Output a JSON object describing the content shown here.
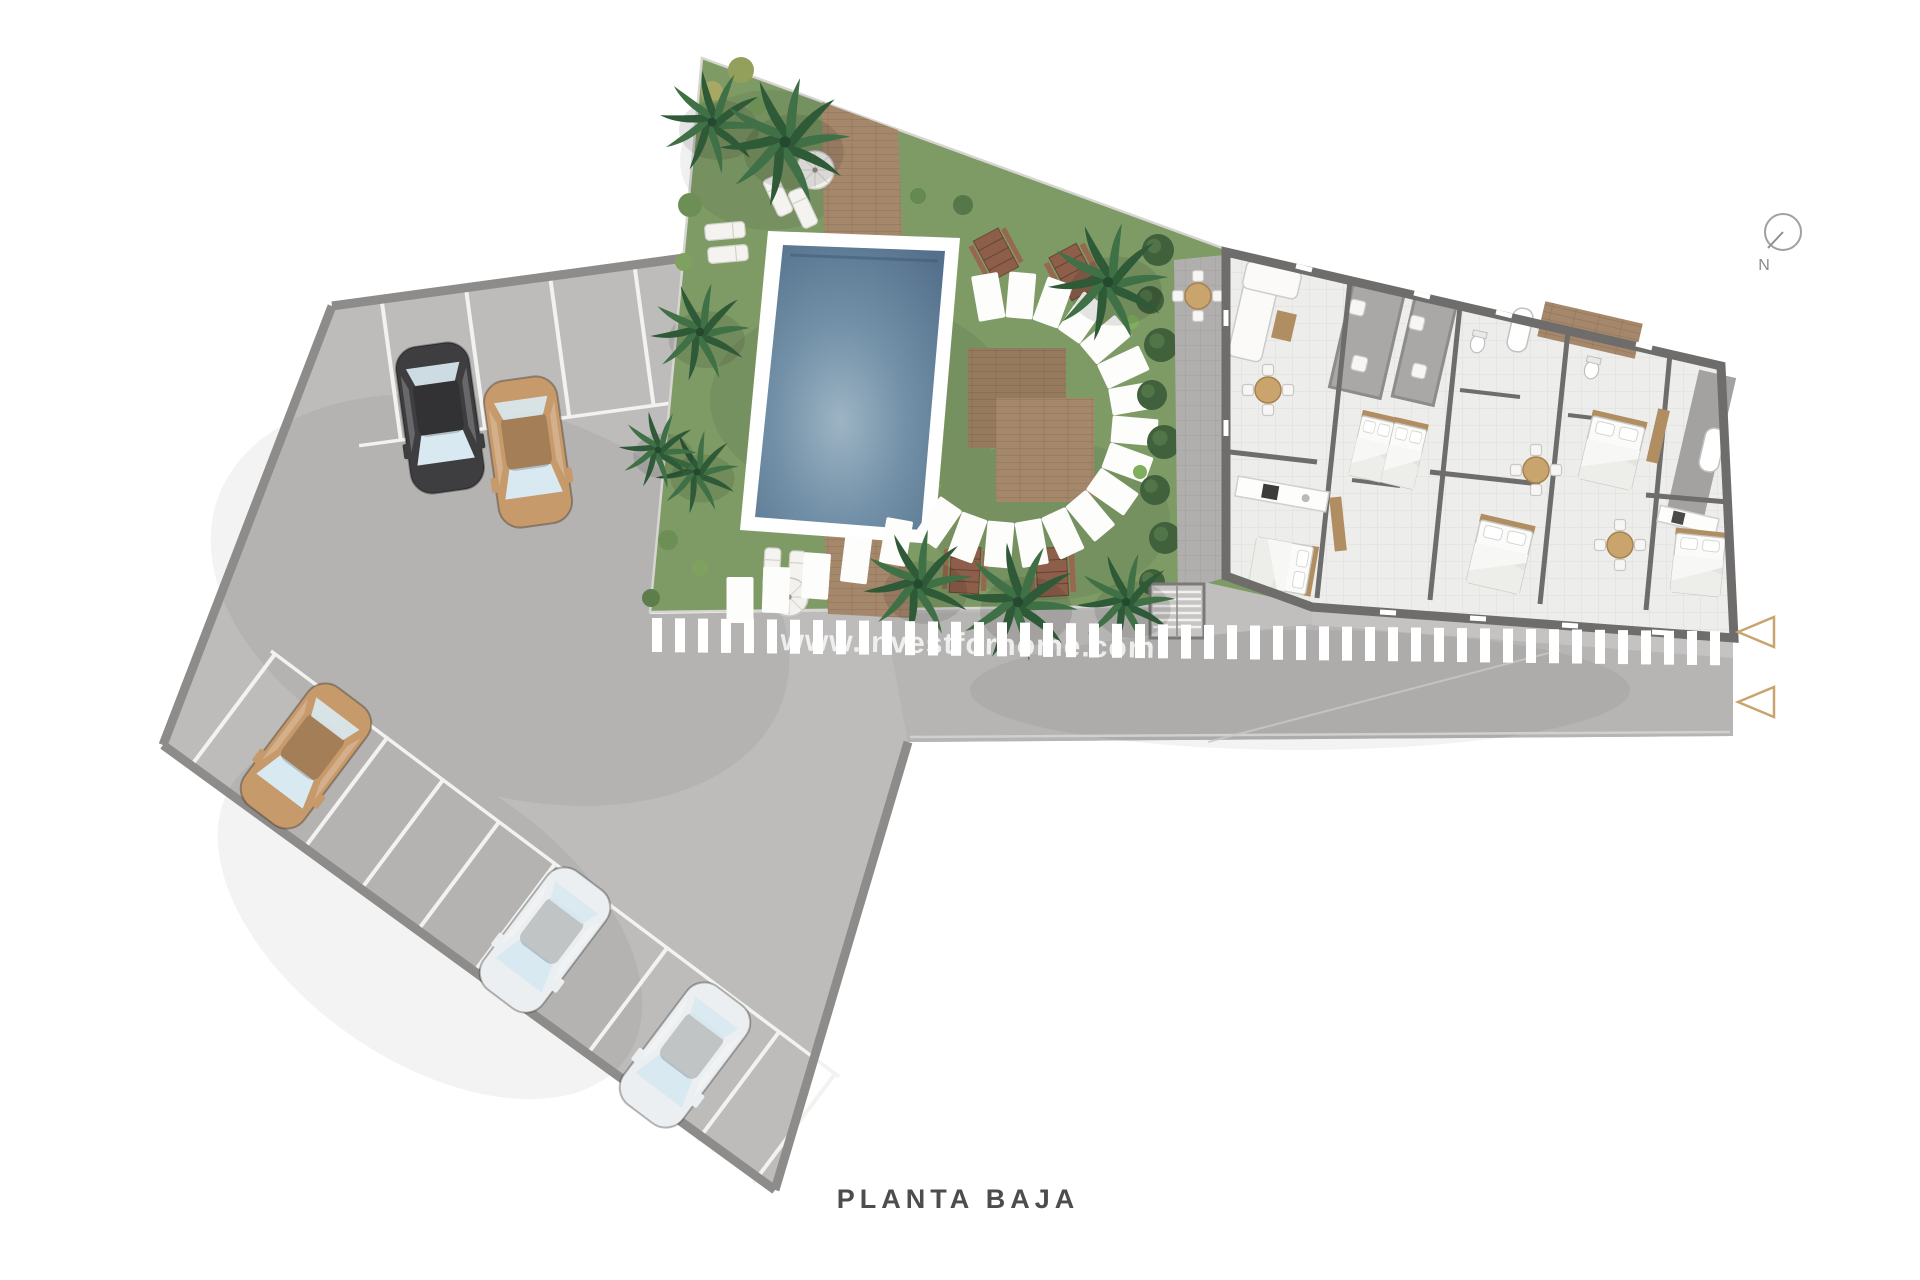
{
  "title": "PLANTA BAJA",
  "watermark": "www.investforhome.com",
  "compass": {
    "label": "N"
  },
  "site": {
    "cars": [
      {
        "color": "#3e3e40",
        "location": "top-row"
      },
      {
        "color": "#c79a6b",
        "location": "top-row"
      },
      {
        "color": "#c79a6b",
        "location": "west-row"
      },
      {
        "color": "#eceff1",
        "location": "south-row"
      },
      {
        "color": "#eceff1",
        "location": "south-row"
      }
    ],
    "entrance_arrows": 2,
    "colors": {
      "asphalt": "#bdbcba",
      "road": "#b6b5b3",
      "grass": "#7e9b66",
      "grass_dark": "#6e8c58",
      "pool_water": "#5d7a93",
      "pool_water_light": "#9db4c4",
      "pool_rim": "#ffffff",
      "deck_wood": "#a5876b",
      "deck_wood_dark": "#967a5e",
      "wall": "#6e6d6b",
      "floor_tile": "#ededeb",
      "paving": "#b0afad",
      "paving_dark": "#a3a2a0",
      "hedge": "#41603c",
      "palm": "#35663e",
      "accent_tan": "#c9a46d",
      "stripe_white": "#ffffff",
      "line_white": "#f2f2f0",
      "border_gray": "#8d8c8a",
      "title_color": "#4d4d4d"
    }
  }
}
